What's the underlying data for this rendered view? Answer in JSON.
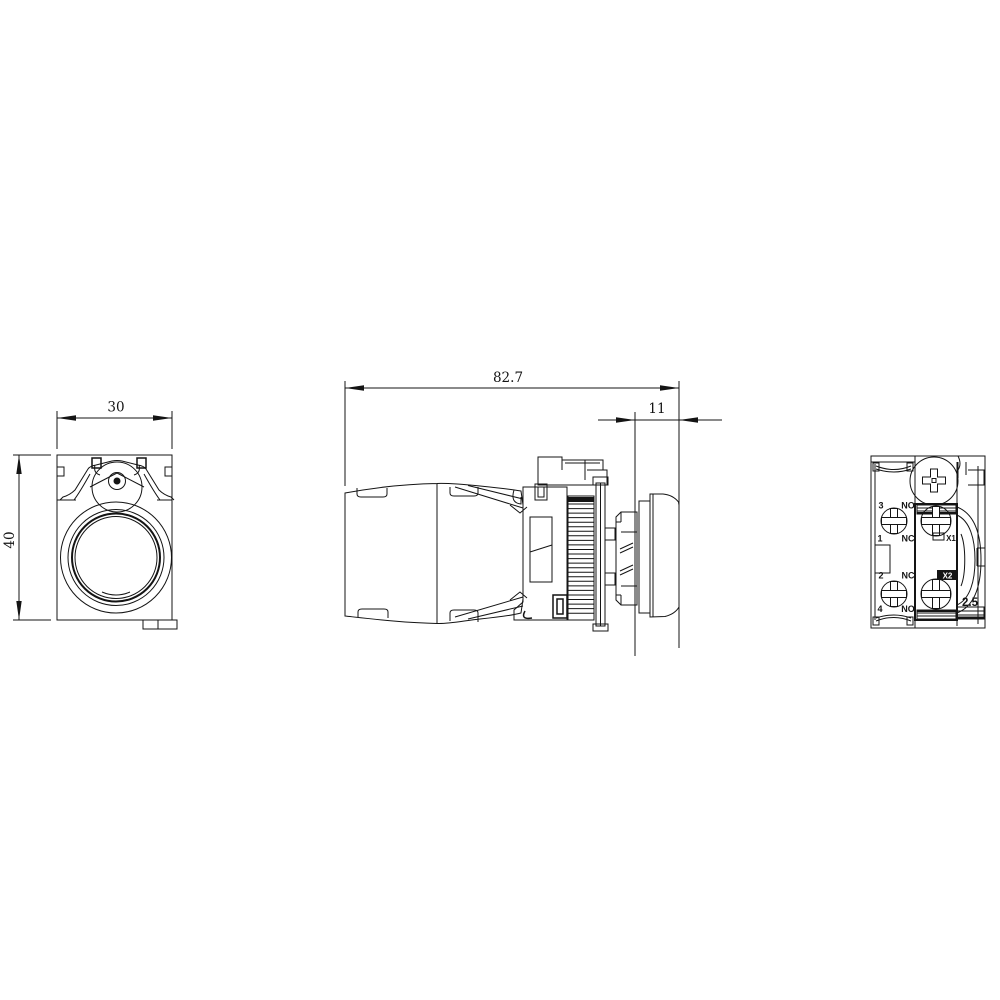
{
  "drawing": {
    "kind": "pushbutton-dimensional-drawing",
    "colors": {
      "line": "#141414",
      "background": "#ffffff"
    },
    "views": {
      "front": {
        "dim_width": "30",
        "dim_height": "40"
      },
      "side": {
        "dim_total_length": "82.7",
        "dim_cap_length": "11"
      },
      "rear": {
        "terminal_3": "3",
        "terminal_1": "1",
        "terminal_2": "2",
        "terminal_4": "4",
        "contact_no_top": "NO",
        "contact_nc_top": "NC",
        "contact_nc_bottom": "NC",
        "contact_no_bottom": "NO",
        "lamp_terminal_x1": "X1",
        "lamp_terminal_x2": "X2",
        "clamp_capacity": "2.5"
      }
    }
  }
}
